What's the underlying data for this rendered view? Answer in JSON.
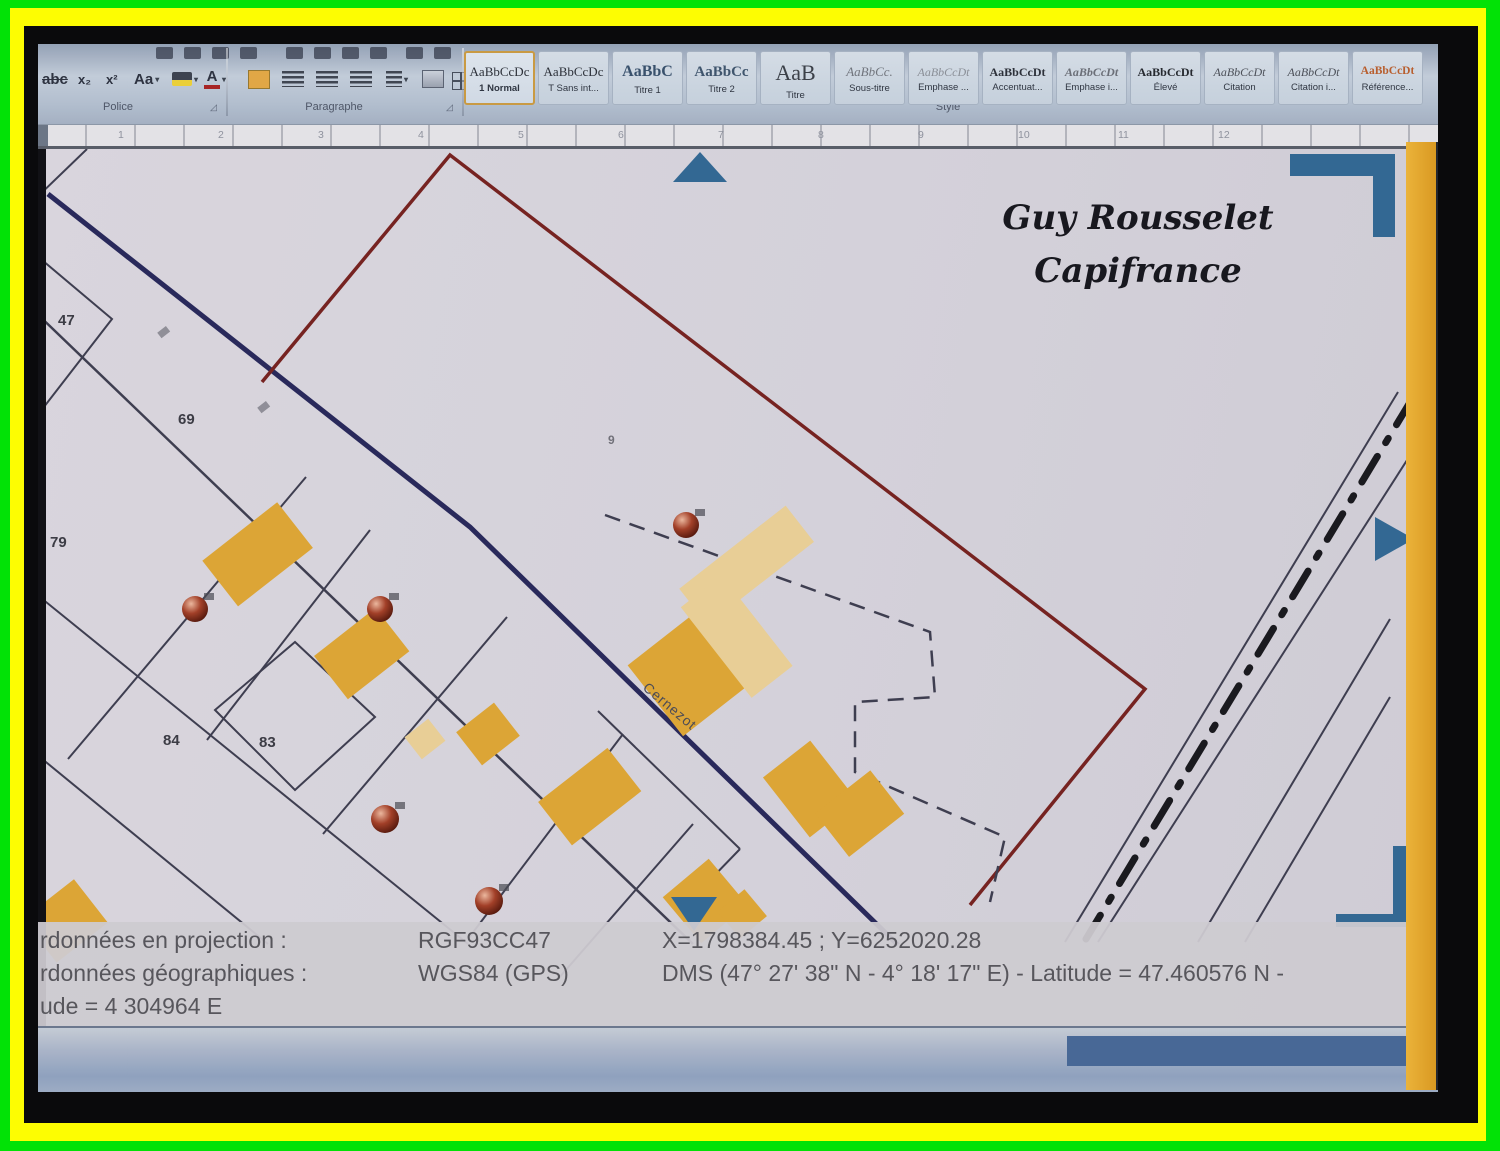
{
  "ribbon": {
    "groups": [
      {
        "label": "Police"
      },
      {
        "label": "Paragraphe"
      },
      {
        "label": "Style"
      }
    ],
    "styles": [
      {
        "sample": "AaBbCcDc",
        "label": "1 Normal",
        "selected": true
      },
      {
        "sample": "AaBbCcDc",
        "label": "T Sans int...",
        "selected": false
      },
      {
        "sample": "AaBbC",
        "label": "Titre 1",
        "selected": false
      },
      {
        "sample": "AaBbCc",
        "label": "Titre 2",
        "selected": false
      },
      {
        "sample": "AaB",
        "label": "Titre",
        "selected": false
      },
      {
        "sample": "AaBbCc.",
        "label": "Sous-titre",
        "selected": false
      },
      {
        "sample": "AaBbCcDt",
        "label": "Emphase ...",
        "selected": false
      },
      {
        "sample": "AaBbCcDt",
        "label": "Accentuat...",
        "selected": false
      },
      {
        "sample": "AaBbCcDt",
        "label": "Emphase i...",
        "selected": false
      },
      {
        "sample": "AaBbCcDt",
        "label": "Élevé",
        "selected": false
      },
      {
        "sample": "AaBbCcDt",
        "label": "Citation",
        "selected": false
      },
      {
        "sample": "AaBbCcDt",
        "label": "Citation i...",
        "selected": false
      },
      {
        "sample": "AaBbCcDt",
        "label": "Référence...",
        "selected": false
      }
    ]
  },
  "ruler": {
    "numbers": [
      "1",
      "2",
      "3",
      "4",
      "5",
      "6",
      "7",
      "8",
      "9",
      "10",
      "11",
      "12"
    ]
  },
  "map": {
    "watermark": {
      "line1": "Guy Rousselet",
      "line2": "Capifrance"
    },
    "street": "Cernezot",
    "parcels": [
      {
        "label": "47"
      },
      {
        "label": "69"
      },
      {
        "label": "79"
      },
      {
        "label": "84"
      },
      {
        "label": "83"
      },
      {
        "label": "9"
      }
    ]
  },
  "info": {
    "rows": [
      {
        "c1": "rdonnées en projection :",
        "c2": "RGF93CC47",
        "c3": "X=1798384.45 ; Y=6252020.28"
      },
      {
        "c1": "rdonnées géographiques :",
        "c2": "WGS84 (GPS)",
        "c3": "DMS (47° 27' 38\" N - 4° 18' 17\" E) - Latitude = 47.460576 N -"
      },
      {
        "c1": "ude = 4 304964 E",
        "c2": "",
        "c3": ""
      }
    ]
  },
  "colors": {
    "frame_green": "#02e206",
    "frame_yellow": "#fdfd02",
    "building_yellow": "#e3a62b",
    "building_light": "#edd092",
    "boundary_red": "#7b1f1c",
    "road_navy": "#26265e",
    "marker_blue": "#2d6898",
    "scrollbar_orange": "#edaa1e"
  }
}
